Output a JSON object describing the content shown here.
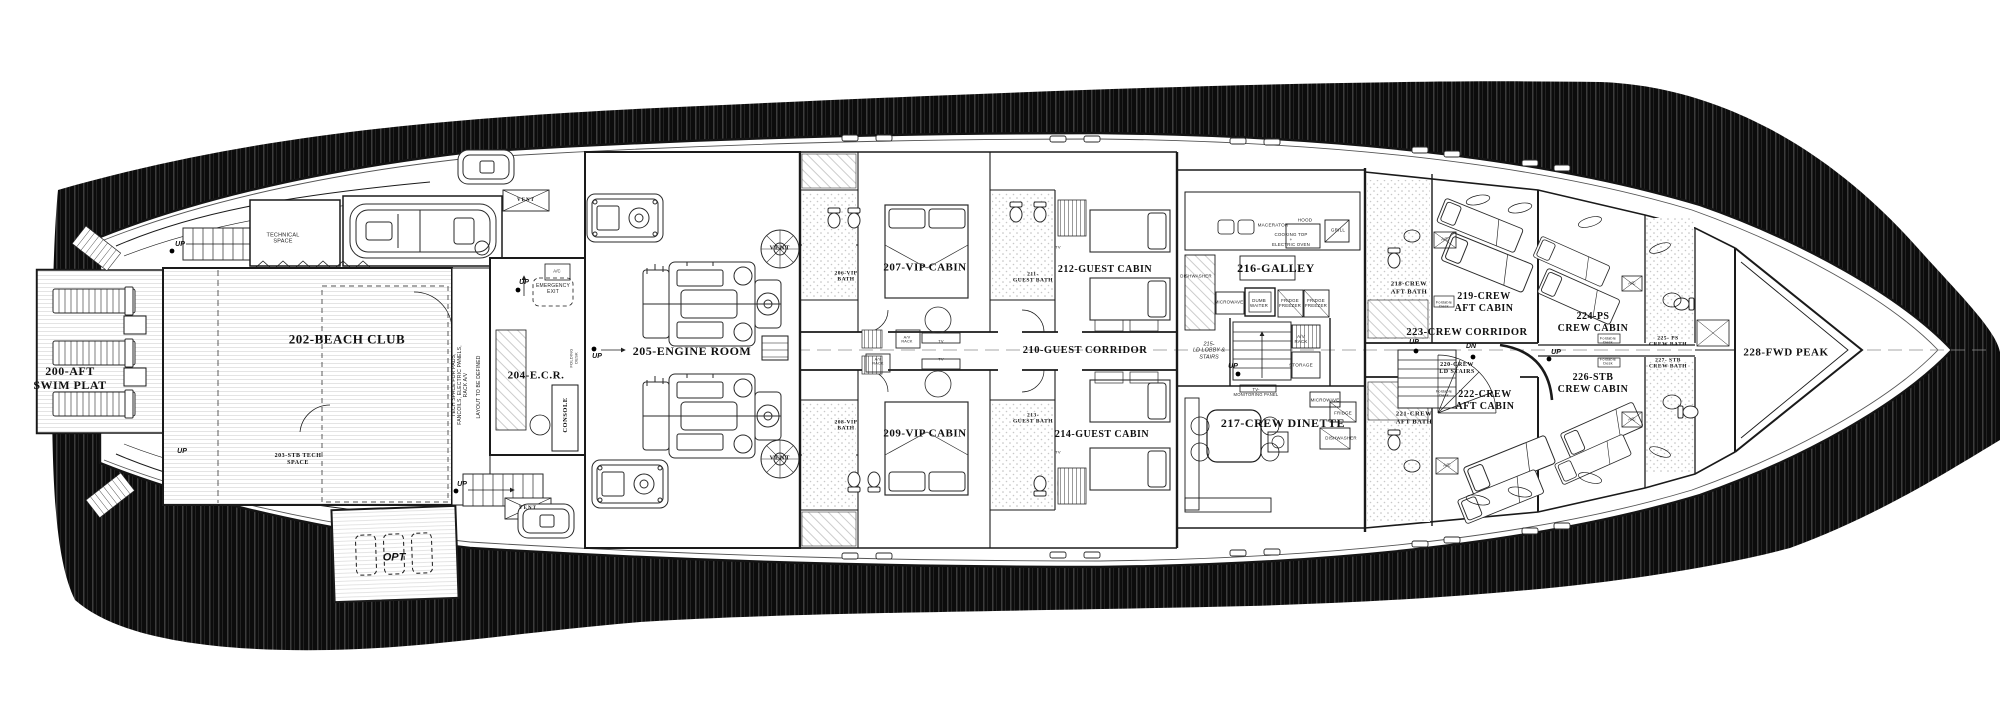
{
  "colors": {
    "paper": "#ffffff",
    "ink": "#1a1a1a",
    "shadow": "#0c0c0c",
    "deck_line": "#d9d9d9"
  },
  "plan": {
    "rooms": [
      {
        "n": "room-200-aft-swim-platform",
        "t": "200-AFT\nSWIM PLAT",
        "x": 70,
        "y": 378,
        "fs": 12,
        "c": "room"
      },
      {
        "n": "room-202-beach-club",
        "t": "202-BEACH CLUB",
        "x": 347,
        "y": 339,
        "fs": 13,
        "c": "room"
      },
      {
        "n": "room-203-stb-tech-space",
        "t": "203-STB TECH\nSPACE",
        "x": 298,
        "y": 460,
        "fs": 6,
        "c": "room"
      },
      {
        "n": "room-204-ecr",
        "t": "204-E.C.R.",
        "x": 536,
        "y": 376,
        "fs": 11,
        "c": "room"
      },
      {
        "n": "room-205-engine-room",
        "t": "205-ENGINE ROOM",
        "x": 692,
        "y": 351,
        "fs": 12,
        "c": "room"
      },
      {
        "n": "room-206-vip-bath",
        "t": "206-VIP\nBATH",
        "x": 846,
        "y": 277,
        "fs": 5.5,
        "c": "room"
      },
      {
        "n": "room-207-vip-cabin",
        "t": "207-VIP CABIN",
        "x": 925,
        "y": 268,
        "fs": 11,
        "c": "room"
      },
      {
        "n": "room-208-vip-bath",
        "t": "208-VIP\nBATH",
        "x": 846,
        "y": 426,
        "fs": 5.5,
        "c": "room"
      },
      {
        "n": "room-209-vip-cabin",
        "t": "209-VIP CABIN",
        "x": 925,
        "y": 434,
        "fs": 11,
        "c": "room"
      },
      {
        "n": "room-210-guest-corridor",
        "t": "210-GUEST CORRIDOR",
        "x": 1085,
        "y": 351,
        "fs": 10.5,
        "c": "room"
      },
      {
        "n": "room-211-guest-bath",
        "t": "211-\nGUEST BATH",
        "x": 1033,
        "y": 278,
        "fs": 5.5,
        "c": "room"
      },
      {
        "n": "room-212-guest-cabin",
        "t": "212-GUEST CABIN",
        "x": 1105,
        "y": 270,
        "fs": 10,
        "c": "room"
      },
      {
        "n": "room-213-guest-bath",
        "t": "213-\nGUEST BATH",
        "x": 1033,
        "y": 419,
        "fs": 5.5,
        "c": "room"
      },
      {
        "n": "room-214-guest-cabin",
        "t": "214-GUEST CABIN",
        "x": 1102,
        "y": 435,
        "fs": 10,
        "c": "room"
      },
      {
        "n": "room-215-ld-lobby-stairs",
        "t": "215-\nLD LOBBY &\nSTAIRS",
        "x": 1209,
        "y": 351,
        "fs": 5.5,
        "c": "tiny-i"
      },
      {
        "n": "room-216-galley",
        "t": "216-GALLEY",
        "x": 1276,
        "y": 268,
        "fs": 12,
        "c": "room"
      },
      {
        "n": "room-217-crew-dinette",
        "t": "217-CREW DINETTE",
        "x": 1283,
        "y": 423,
        "fs": 12,
        "c": "room"
      },
      {
        "n": "room-218-crew-aft-bath",
        "t": "218-CREW\nAFT BATH",
        "x": 1409,
        "y": 288,
        "fs": 6.5,
        "c": "room"
      },
      {
        "n": "room-219-crew-aft-cabin",
        "t": "219-CREW\nAFT CABIN",
        "x": 1484,
        "y": 303,
        "fs": 10,
        "c": "room"
      },
      {
        "n": "room-220-crew-ld-stairs",
        "t": "220-CREW\nLD STAIRS",
        "x": 1457,
        "y": 369,
        "fs": 6,
        "c": "room"
      },
      {
        "n": "room-221-crew-aft-bath",
        "t": "221-CREW\nAFT BATH",
        "x": 1414,
        "y": 418,
        "fs": 6.5,
        "c": "room"
      },
      {
        "n": "room-222-crew-aft-cabin",
        "t": "222-CREW\nAFT CABIN",
        "x": 1485,
        "y": 401,
        "fs": 10,
        "c": "room"
      },
      {
        "n": "room-223-crew-corridor",
        "t": "223-CREW CORRIDOR",
        "x": 1467,
        "y": 333,
        "fs": 10.5,
        "c": "room"
      },
      {
        "n": "room-224-ps-crew-cabin",
        "t": "224-PS\nCREW CABIN",
        "x": 1593,
        "y": 323,
        "fs": 10,
        "c": "room"
      },
      {
        "n": "room-225-ps-crew-bath",
        "t": "225- PS\nCREW BATH",
        "x": 1668,
        "y": 342,
        "fs": 5.5,
        "c": "room"
      },
      {
        "n": "room-226-stb-crew-cabin",
        "t": "226-STB\nCREW CABIN",
        "x": 1593,
        "y": 384,
        "fs": 10,
        "c": "room"
      },
      {
        "n": "room-227-stb-crew-bath",
        "t": "227- STB\nCREW BATH",
        "x": 1668,
        "y": 364,
        "fs": 5.5,
        "c": "room"
      },
      {
        "n": "room-228-fwd-peak",
        "t": "228-FWD PEAK",
        "x": 1786,
        "y": 353,
        "fs": 11,
        "c": "room"
      },
      {
        "n": "room-technical-space",
        "t": "TECHNICAL\nSPACE",
        "x": 283,
        "y": 239,
        "fs": 5.5,
        "c": "tiny"
      }
    ],
    "annotations": [
      {
        "n": "label-macerator",
        "t": "MACERATOR",
        "x": 1273,
        "y": 225,
        "fs": 4.6,
        "c": "tiny"
      },
      {
        "n": "label-hood",
        "t": "HOOD",
        "x": 1305,
        "y": 220,
        "fs": 4.6,
        "c": "tiny"
      },
      {
        "n": "label-cooking-top-oven",
        "t": "COOKING TOP\n+\nELECTRIC OVEN",
        "x": 1291,
        "y": 240,
        "fs": 4.4,
        "c": "tiny"
      },
      {
        "n": "label-grill",
        "t": "GRILL",
        "x": 1338,
        "y": 230,
        "fs": 4.6,
        "c": "tiny"
      },
      {
        "n": "label-dishwasher-galley",
        "t": "DISHWASHER",
        "x": 1196,
        "y": 276,
        "fs": 4.4,
        "c": "tiny"
      },
      {
        "n": "label-microwave-galley",
        "t": "MICROWAVE",
        "x": 1229,
        "y": 302,
        "fs": 4.4,
        "c": "tiny"
      },
      {
        "n": "label-dumb-waiter",
        "t": "DUMB\nWAITER",
        "x": 1259,
        "y": 303,
        "fs": 4.4,
        "c": "tiny"
      },
      {
        "n": "label-fridge-freezer-1",
        "t": "FRIDGE\nFREEZER",
        "x": 1290,
        "y": 303,
        "fs": 4.4,
        "c": "tiny"
      },
      {
        "n": "label-fridge-freezer-2",
        "t": "FRIDGE\nFREEZER",
        "x": 1316,
        "y": 303,
        "fs": 4.4,
        "c": "tiny"
      },
      {
        "n": "label-av-rack-lobby",
        "t": "A/V\nRACK",
        "x": 1301,
        "y": 339,
        "fs": 4.4,
        "c": "tiny"
      },
      {
        "n": "label-storage",
        "t": "STORAGE",
        "x": 1301,
        "y": 365,
        "fs": 4.6,
        "c": "tiny"
      },
      {
        "n": "label-tv-monitoring-panel",
        "t": "TV-\nMONITORING PANEL",
        "x": 1256,
        "y": 393,
        "fs": 4.2,
        "c": "tiny"
      },
      {
        "n": "label-microwave-dinette",
        "t": "MICROWAVE",
        "x": 1325,
        "y": 400,
        "fs": 4.4,
        "c": "tiny"
      },
      {
        "n": "label-fridge-dinette",
        "t": "FRIDGE",
        "x": 1343,
        "y": 413,
        "fs": 4.4,
        "c": "tiny"
      },
      {
        "n": "label-dishwasher-dinette",
        "t": "DISHWASHER",
        "x": 1341,
        "y": 438,
        "fs": 4.4,
        "c": "tiny"
      },
      {
        "n": "label-emergency-exit",
        "t": "EMERGENCY\nEXIT",
        "x": 553,
        "y": 290,
        "fs": 5,
        "c": "tiny"
      },
      {
        "n": "label-console",
        "t": "CONSOLE",
        "x": 566,
        "y": 415,
        "fs": 6.5,
        "c": "room",
        "r": -90
      },
      {
        "n": "label-folding-desk",
        "t": "FOLDING\nDESK",
        "x": 574,
        "y": 358,
        "fs": 4,
        "c": "tiny",
        "r": -90
      },
      {
        "n": "label-tech-space-note",
        "t": "TECH SPACE FOR PADS,\nFANCOILS, ELECTRIC PANELS,\nRACK A/V",
        "x": 461,
        "y": 385,
        "fs": 5,
        "c": "tiny",
        "r": -90
      },
      {
        "n": "label-layout-note",
        "t": "LAYOUT TO BE DEFINED",
        "x": 480,
        "y": 387,
        "fs": 5,
        "c": "tiny",
        "r": -90
      }
    ],
    "markers": [
      {
        "n": "label-vent-box-top",
        "t": "VENT",
        "x": 526,
        "y": 201,
        "fs": 5,
        "c": "vent"
      },
      {
        "n": "label-vent-fan-top",
        "t": "VENT",
        "x": 780,
        "y": 249,
        "fs": 6,
        "c": "vent"
      },
      {
        "n": "label-vent-fan-bottom",
        "t": "VENT",
        "x": 780,
        "y": 459,
        "fs": 6,
        "c": "vent"
      },
      {
        "n": "label-vent-box-bottom",
        "t": "VENT",
        "x": 528,
        "y": 509,
        "fs": 5,
        "c": "vent"
      },
      {
        "n": "label-ac-ecr",
        "t": "A/C",
        "x": 557,
        "y": 272,
        "fs": 4.2,
        "c": "tiny"
      },
      {
        "n": "label-ac-crew-aft-ps",
        "t": "A/C",
        "x": 1445,
        "y": 240,
        "fs": 4.2,
        "c": "tiny"
      },
      {
        "n": "label-ac-crew-fwd-ps",
        "t": "A/C",
        "x": 1632,
        "y": 284,
        "fs": 4.2,
        "c": "tiny"
      },
      {
        "n": "label-ac-crew-aft-stb",
        "t": "A/C",
        "x": 1447,
        "y": 466,
        "fs": 4.2,
        "c": "tiny"
      },
      {
        "n": "label-ac-crew-fwd-stb",
        "t": "A/C",
        "x": 1632,
        "y": 420,
        "fs": 4.2,
        "c": "tiny"
      },
      {
        "n": "label-av-rack-vip-ps",
        "t": "A/V\nRACK",
        "x": 907,
        "y": 340,
        "fs": 3.8,
        "c": "tiny"
      },
      {
        "n": "label-av-rack-vip-stb",
        "t": "A/V\nRACK",
        "x": 878,
        "y": 362,
        "fs": 3.8,
        "c": "tiny"
      },
      {
        "n": "label-tv-vip-ps",
        "t": "TV",
        "x": 941,
        "y": 342,
        "fs": 4,
        "c": "tiny"
      },
      {
        "n": "label-tv-vip-stb",
        "t": "TV",
        "x": 941,
        "y": 360,
        "fs": 4,
        "c": "tiny"
      },
      {
        "n": "label-tv-guest-212",
        "t": "TV",
        "x": 1058,
        "y": 248,
        "fs": 4,
        "c": "tiny"
      },
      {
        "n": "label-tv-guest-214",
        "t": "TV",
        "x": 1058,
        "y": 453,
        "fs": 4,
        "c": "tiny"
      },
      {
        "n": "label-foldable-desk-219",
        "t": "Foldable\nDesk",
        "x": 1444,
        "y": 305,
        "fs": 3.8,
        "c": "tiny"
      },
      {
        "n": "label-foldable-desk-222",
        "t": "Foldable\nDesk",
        "x": 1444,
        "y": 394,
        "fs": 3.8,
        "c": "tiny"
      },
      {
        "n": "label-foldable-desk-224",
        "t": "Foldable\nDesk",
        "x": 1608,
        "y": 341,
        "fs": 3.8,
        "c": "tiny"
      },
      {
        "n": "label-foldable-desk-226",
        "t": "Foldable\nDesk",
        "x": 1608,
        "y": 362,
        "fs": 3.8,
        "c": "tiny"
      },
      {
        "n": "label-opt",
        "t": "OPT",
        "x": 394,
        "y": 558,
        "fs": 11,
        "c": "hand"
      },
      {
        "n": "label-up-aft-port",
        "t": "UP",
        "x": 180,
        "y": 245,
        "fs": 7,
        "c": "hand"
      },
      {
        "n": "label-up-aft-stb",
        "t": "UP",
        "x": 182,
        "y": 452,
        "fs": 7,
        "c": "hand"
      },
      {
        "n": "label-up-beach-exit",
        "t": "UP",
        "x": 462,
        "y": 485,
        "fs": 7,
        "c": "hand"
      },
      {
        "n": "label-up-ecr",
        "t": "UP",
        "x": 524,
        "y": 283,
        "fs": 7,
        "c": "hand"
      },
      {
        "n": "label-up-engine-room",
        "t": "UP",
        "x": 597,
        "y": 357,
        "fs": 7,
        "c": "hand"
      },
      {
        "n": "label-up-ld-lobby",
        "t": "UP",
        "x": 1233,
        "y": 367,
        "fs": 7,
        "c": "hand"
      },
      {
        "n": "label-up-crew-corridor",
        "t": "UP",
        "x": 1414,
        "y": 343,
        "fs": 7,
        "c": "hand"
      },
      {
        "n": "label-dn-crew-corridor",
        "t": "DN",
        "x": 1471,
        "y": 347,
        "fs": 7,
        "c": "hand"
      },
      {
        "n": "label-up-crew-fwd",
        "t": "UP",
        "x": 1556,
        "y": 353,
        "fs": 7,
        "c": "hand"
      }
    ]
  }
}
